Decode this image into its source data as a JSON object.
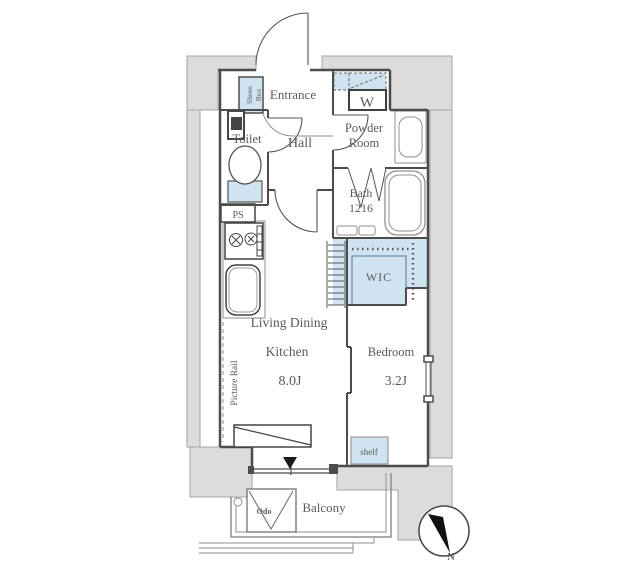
{
  "plan": {
    "labels": {
      "entrance": "Entrance",
      "shoes_box": [
        "Shoes",
        "Box"
      ],
      "hall": "Hall",
      "toilet": "Toilet",
      "powder_room": [
        "Powder",
        "Room"
      ],
      "washing_machine": "W",
      "bath": [
        "Bath",
        "1216"
      ],
      "pipe_space": "PS",
      "wic": "WIC",
      "living_dining_kitchen": [
        "Living Dining",
        "Kitchen",
        "8.0J"
      ],
      "picture_rail": "Picture Rail",
      "bedroom": [
        "Bedroom",
        "3.2J"
      ],
      "shelf": "shelf",
      "balcony": "Balcony",
      "water_heater": "Odo",
      "compass_north": "N"
    },
    "rooms": [
      {
        "name": "Entrance"
      },
      {
        "name": "Hall"
      },
      {
        "name": "Toilet"
      },
      {
        "name": "Powder Room"
      },
      {
        "name": "Bath",
        "size": "1216"
      },
      {
        "name": "WIC"
      },
      {
        "name": "Living Dining Kitchen",
        "size": "8.0J"
      },
      {
        "name": "Bedroom",
        "size": "3.2J"
      },
      {
        "name": "Balcony"
      }
    ],
    "fixtures": [
      "Shoes Box",
      "W",
      "PS",
      "Picture Rail",
      "shelf",
      "Odo"
    ],
    "colors": {
      "highlight": "#cfe3f1",
      "highlight_inner": "#d9ebf6",
      "outside_area": "#dcdcdc",
      "outside_border": "#a3a3a3",
      "wall": "#4c4c4c",
      "fixture_line": "#8f8f8f",
      "text": "#5a5a5a"
    }
  }
}
